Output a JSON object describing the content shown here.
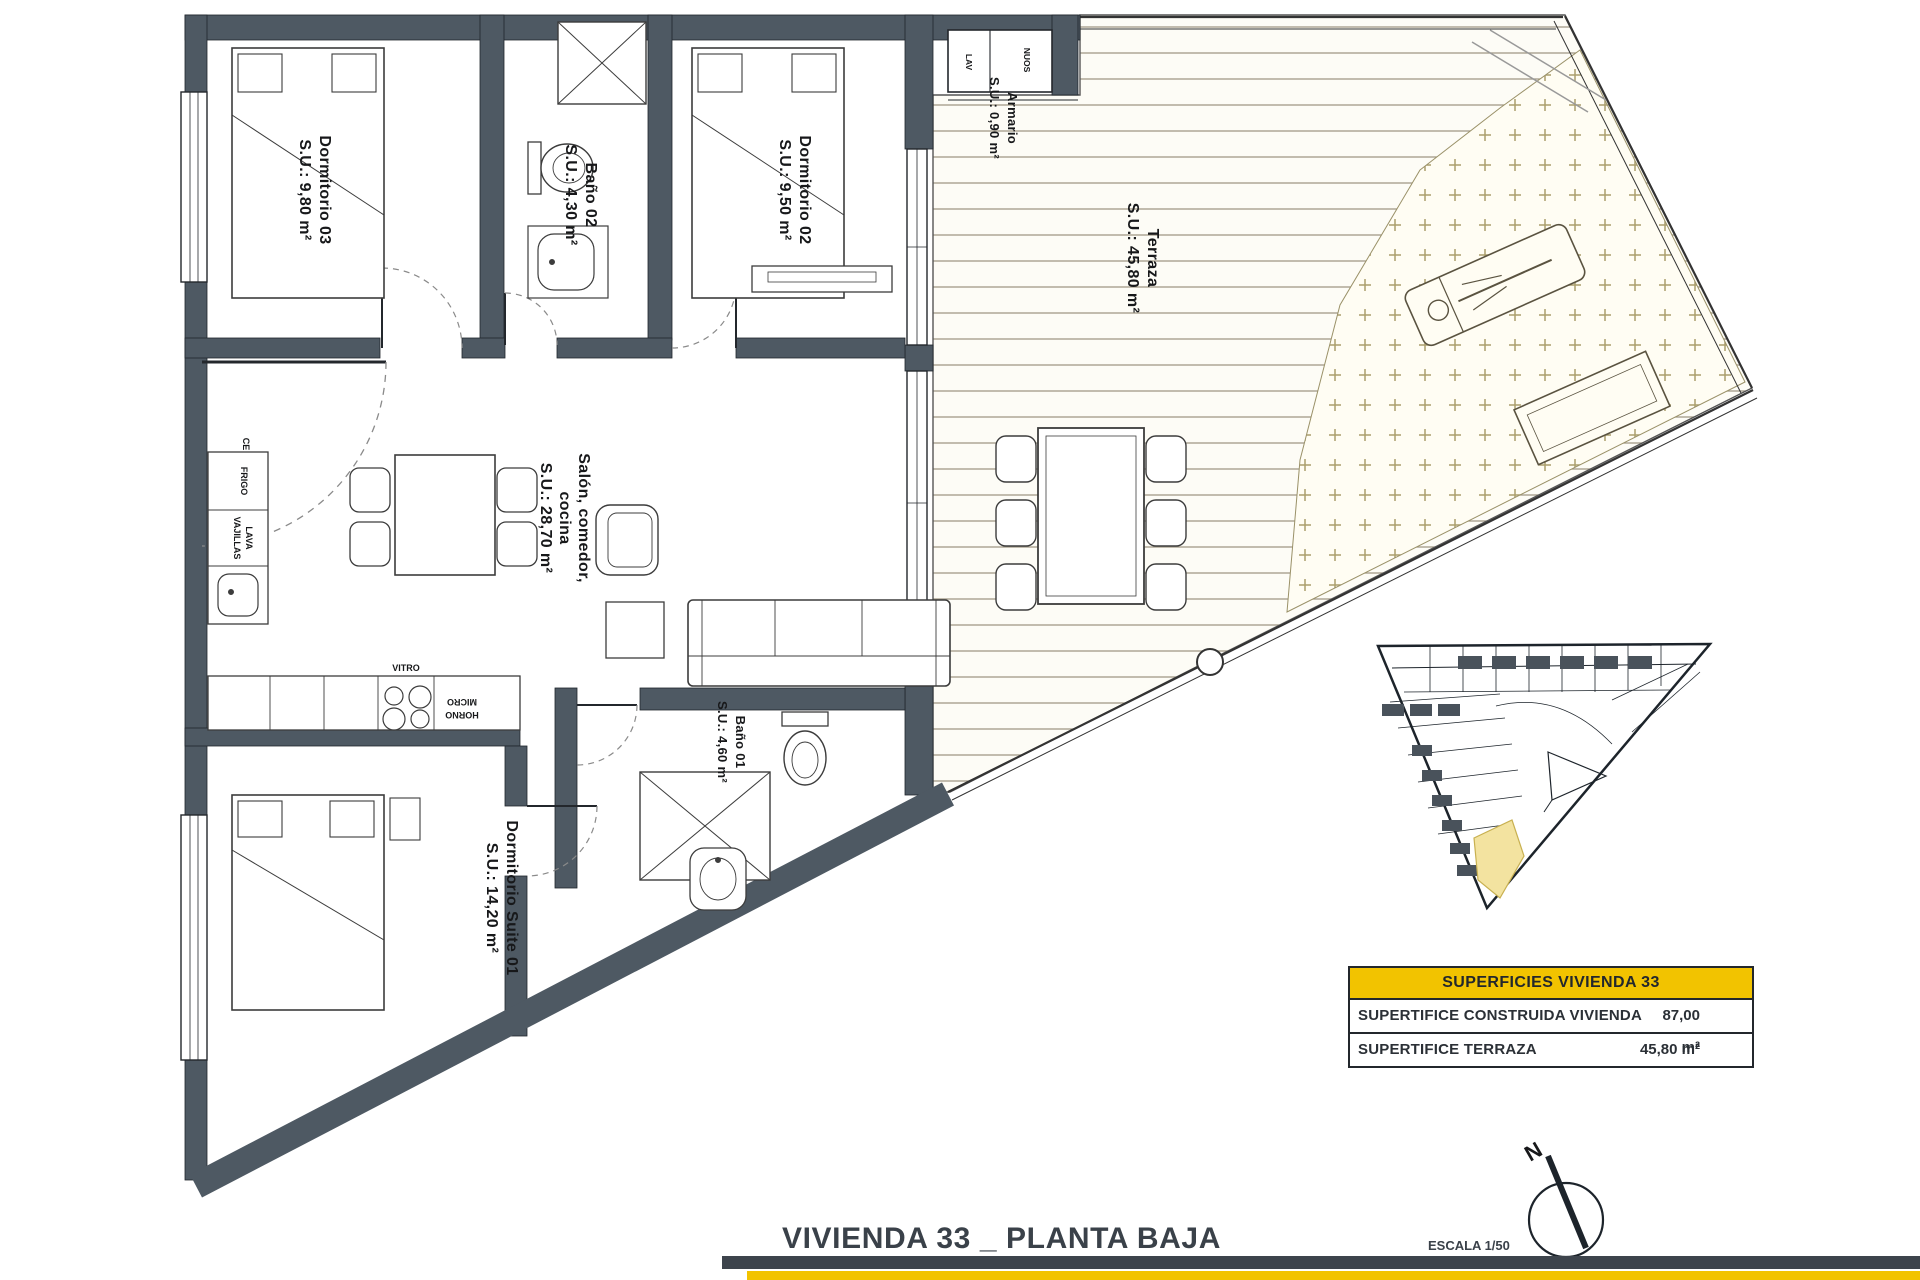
{
  "plan": {
    "rooms": {
      "dorm03": {
        "name": "Dormitorio 03",
        "area": "S.U.: 9,80 m²"
      },
      "bano02": {
        "name": "Baño 02",
        "area": "S.U.: 4,30 m²"
      },
      "dorm02": {
        "name": "Dormitorio 02",
        "area": "S.U.: 9,50 m²"
      },
      "armario": {
        "name": "Armario",
        "area": "S.U.: 0,90 m²"
      },
      "terraza": {
        "name": "Terraza",
        "area": "S.U.: 45,80 m²"
      },
      "salon": {
        "line1": "Salón, comedor,",
        "line2": "cocina",
        "area": "S.U.: 28,70 m²"
      },
      "bano01": {
        "name": "Baño 01",
        "area": "S.U.: 4,60 m²"
      },
      "suite": {
        "name": "Dormitorio Suite 01",
        "area": "S.U.: 14,20 m²"
      }
    },
    "kitchen": {
      "fridge": "FRIGO",
      "dishwasher1": "LAVA",
      "dishwasher2": "VAJILLAS",
      "hob": "VITRO",
      "oven1": "HORNO",
      "oven2": "MICRO",
      "electric_panel": "CE"
    },
    "utility": {
      "label": "NUOS",
      "washer": "LAV"
    }
  },
  "legend": {
    "header": "SUPERFICIES VIVIENDA 33",
    "rows": [
      {
        "label": "SUPERTIFICE CONSTRUIDA VIVIENDA",
        "value": "87,00 m²"
      },
      {
        "label": "SUPERTIFICE TERRAZA",
        "value": "45,80 m²"
      }
    ]
  },
  "footer": {
    "title": "VIVIENDA 33 _ PLANTA BAJA",
    "scale": "ESCALA 1/50",
    "north": "N"
  },
  "colors": {
    "wall": "#4e5963",
    "accent_yellow": "#f2c300",
    "site_highlight": "#f3e3a0",
    "bar_dark": "#3d444c"
  }
}
